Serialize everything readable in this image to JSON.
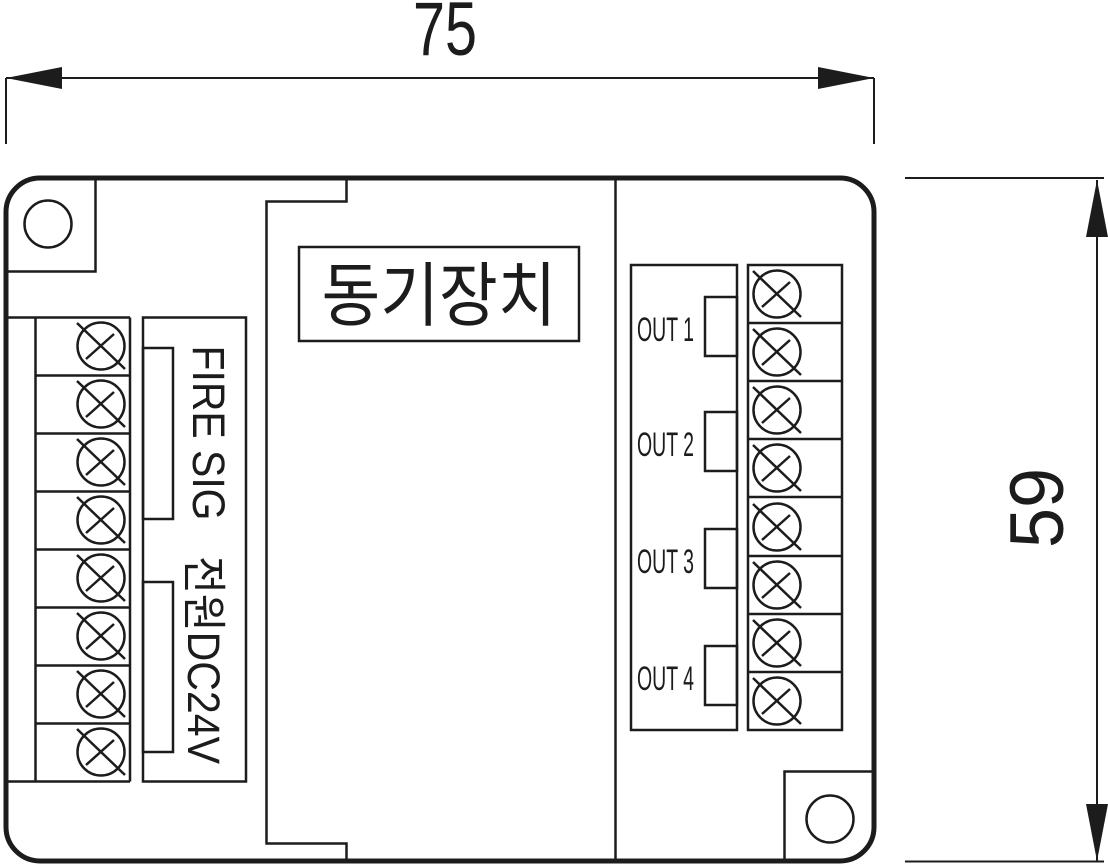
{
  "drawing": {
    "type": "technical-dimension-drawing",
    "device_title": "동기장치",
    "dimensions": {
      "width_label": "75",
      "height_label": "59"
    },
    "left_terminal_block": {
      "terminal_count": 8,
      "groups": [
        {
          "label": "FIRE SIG",
          "terminals": 4
        },
        {
          "label": "전원DC24V",
          "terminals": 4
        }
      ]
    },
    "right_terminal_block": {
      "terminal_count": 8,
      "outputs": [
        {
          "label": "OUT 1",
          "terminals": 2
        },
        {
          "label": "OUT 2",
          "terminals": 2
        },
        {
          "label": "OUT 3",
          "terminals": 2
        },
        {
          "label": "OUT 4",
          "terminals": 2
        }
      ]
    },
    "mounting_holes": 2,
    "colors": {
      "line": "#1c1c1c",
      "background": "#ffffff"
    }
  }
}
